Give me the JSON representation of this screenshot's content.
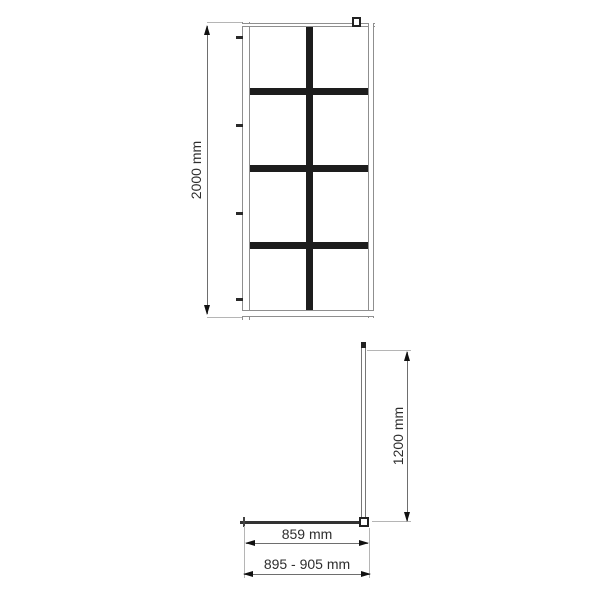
{
  "drawing": {
    "front_view": {
      "height_dimension": "2000 mm",
      "grid_columns": 2,
      "grid_rows": 4
    },
    "plan_view": {
      "depth_dimension": "1200 mm",
      "glass_width_dimension": "859 mm",
      "adjustment_width_dimension": "895 - 905 mm"
    },
    "colors": {
      "background": "#ffffff",
      "frame_line": "#8f8f8f",
      "grid_bar": "#1d1d1d",
      "dimension_line": "#6e6e6e",
      "extension_line": "#b5b5b5",
      "text": "#2e2e2e"
    }
  }
}
